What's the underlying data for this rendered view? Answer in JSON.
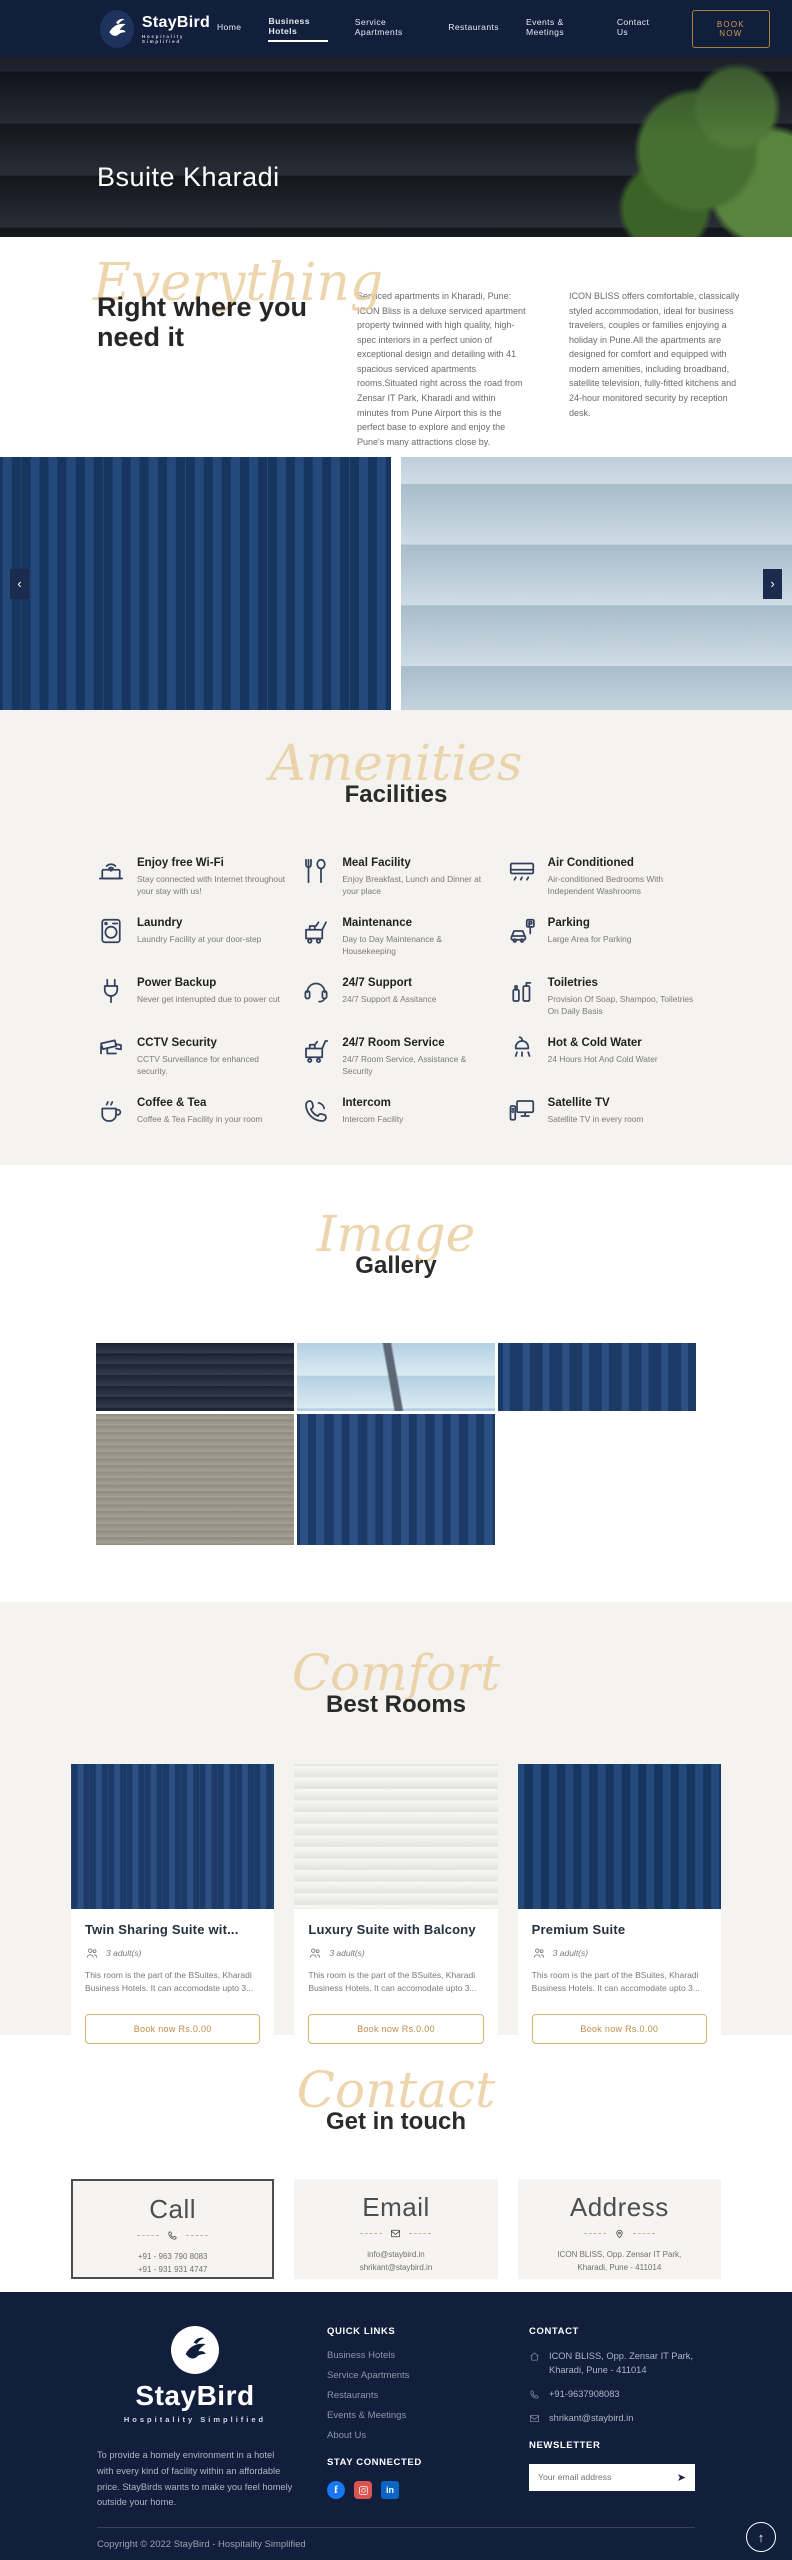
{
  "colors": {
    "navy": "#111e3c",
    "accent_gold": "#c08c4a",
    "script_tan": "#eace9f",
    "section_gray": "#f4f3f0"
  },
  "icons": {
    "prev": "‹",
    "next": "›",
    "send": "➤",
    "scroll_top": "↑",
    "facebook_glyph": "f",
    "linkedin_glyph": "in"
  },
  "header": {
    "brand": {
      "name": "StayBird",
      "tagline": "Hospitality Simplified"
    },
    "nav": [
      {
        "label": "Home"
      },
      {
        "label": "Business Hotels"
      },
      {
        "label": "Service Apartments"
      },
      {
        "label": "Restaurants"
      },
      {
        "label": "Events & Meetings"
      },
      {
        "label": "Contact Us"
      }
    ],
    "book_now_label": "BOOK NOW"
  },
  "hero": {
    "title": "Bsuite Kharadi"
  },
  "intro": {
    "script_word": "Everything",
    "heading": "Right where you need it",
    "paragraph1": "Serviced apartments in Kharadi, Pune: ICON Bliss is a deluxe serviced apartment property twinned with high quality, high-spec interiors in a perfect union of exceptional design and detailing with 41 spacious serviced apartments rooms.Situated right across the road from Zensar IT Park, Kharadi and within minutes from Pune Airport this is the perfect base to explore and enjoy the Pune's many attractions close by.",
    "paragraph2": "ICON BLISS offers comfortable, classically styled accommodation, ideal for business travelers, couples or families enjoying a holiday in Pune.All the apartments are designed for comfort and equipped with modern amenities, including broadband, satellite television, fully-fitted kitchens and 24-hour monitored security by reception desk."
  },
  "facilities": {
    "script_word": "Amenities",
    "heading": "Facilities",
    "items": [
      {
        "title": "Enjoy free Wi-Fi",
        "description": "Stay connected with Internet throughout your stay with us!",
        "icon": "wifi-laptop-icon"
      },
      {
        "title": "Meal Facility",
        "description": "Enjoy Breakfast, Lunch and Dinner at your place",
        "icon": "cutlery-icon"
      },
      {
        "title": "Air Conditioned",
        "description": "Air-conditioned Bedrooms With Independent Washrooms",
        "icon": "air-conditioner-icon"
      },
      {
        "title": "Laundry",
        "description": "Laundry Facility at your door-step",
        "icon": "washing-machine-icon"
      },
      {
        "title": "Maintenance",
        "description": "Day to Day Maintenance & Housekeeping",
        "icon": "housekeeping-cart-icon"
      },
      {
        "title": "Parking",
        "description": "Large Area for Parking",
        "icon": "car-parking-icon"
      },
      {
        "title": "Power Backup",
        "description": "Never get interrupted due to power cut",
        "icon": "power-plug-icon"
      },
      {
        "title": "24/7 Support",
        "description": "24/7 Support & Assitance",
        "icon": "headset-icon"
      },
      {
        "title": "Toiletries",
        "description": "Provision Of Soap, Shampoo, Toiletries On Daily Basis",
        "icon": "toiletries-bottles-icon"
      },
      {
        "title": "CCTV Security",
        "description": "CCTV Surveillance for enhanced security.",
        "icon": "cctv-camera-icon"
      },
      {
        "title": "24/7 Room Service",
        "description": "24/7 Room Service, Assistance & Security",
        "icon": "service-cart-icon"
      },
      {
        "title": "Hot & Cold Water",
        "description": "24 Hours Hot And Cold Water",
        "icon": "shower-icon"
      },
      {
        "title": "Coffee & Tea",
        "description": "Coffee & Tea Facility in your room",
        "icon": "coffee-cup-icon"
      },
      {
        "title": "Intercom",
        "description": "Intercom Facility",
        "icon": "phone-handset-icon"
      },
      {
        "title": "Satellite TV",
        "description": "Satellite TV in every room",
        "icon": "tv-remote-icon"
      }
    ]
  },
  "gallery": {
    "script_word": "Image",
    "heading": "Gallery"
  },
  "rooms": {
    "script_word": "Comfort",
    "heading": "Best Rooms",
    "cards": [
      {
        "title": "Twin Sharing Suite wit...",
        "occupancy": "3 adult(s)",
        "description": "This room is the part of the BSuites, Kharadi Business Hotels. It can accomodate upto 3...",
        "button_label": "Book now Rs.0.00"
      },
      {
        "title": "Luxury Suite with Balcony",
        "occupancy": "3 adult(s)",
        "description": "This room is the part of the BSuites, Kharadi Business Hotels. It can accomodate upto 3...",
        "button_label": "Book now Rs.0.00"
      },
      {
        "title": "Premium Suite",
        "occupancy": "3 adult(s)",
        "description": "This room is the part of the BSuites, Kharadi Business Hotels. It can accomodate upto 3...",
        "button_label": "Book now Rs.0.00"
      }
    ]
  },
  "contact": {
    "script_word": "Contact",
    "heading": "Get in touch",
    "cards": [
      {
        "title": "Call",
        "icon": "phone-icon",
        "line1": "+91 - 963 790 8083",
        "line2": "+91 - 931 931 4747"
      },
      {
        "title": "Email",
        "icon": "envelope-icon",
        "line1": "info@staybird.in",
        "line2": "shrikant@staybird.in"
      },
      {
        "title": "Address",
        "icon": "map-pin-icon",
        "line1": "ICON BLISS, Opp. Zensar IT Park,",
        "line2": "Kharadi, Pune - 411014"
      }
    ]
  },
  "footer": {
    "brand": {
      "name": "StayBird",
      "tagline": "Hospitality Simplified"
    },
    "about": "To provide a homely environment in a hotel with every kind of facility within an affordable price. StayBirds wants to make you feel homely outside your home.",
    "quick_links_heading": "QUICK LINKS",
    "quick_links": [
      {
        "label": "Business Hotels"
      },
      {
        "label": "Service Apartments"
      },
      {
        "label": "Restaurants"
      },
      {
        "label": "Events & Meetings"
      },
      {
        "label": "About Us"
      }
    ],
    "stay_connected_heading": "STAY CONNECTED",
    "contact_heading": "CONTACT",
    "address": "ICON BLISS, Opp. Zensar IT Park, Kharadi, Pune - 411014",
    "phone": "+91-9637908083",
    "email": "shrikant@staybird.in",
    "newsletter_heading": "NEWSLETTER",
    "newsletter_placeholder": "Your email address",
    "copyright": "Copyright © 2022 StayBird - Hospitality Simplified"
  }
}
